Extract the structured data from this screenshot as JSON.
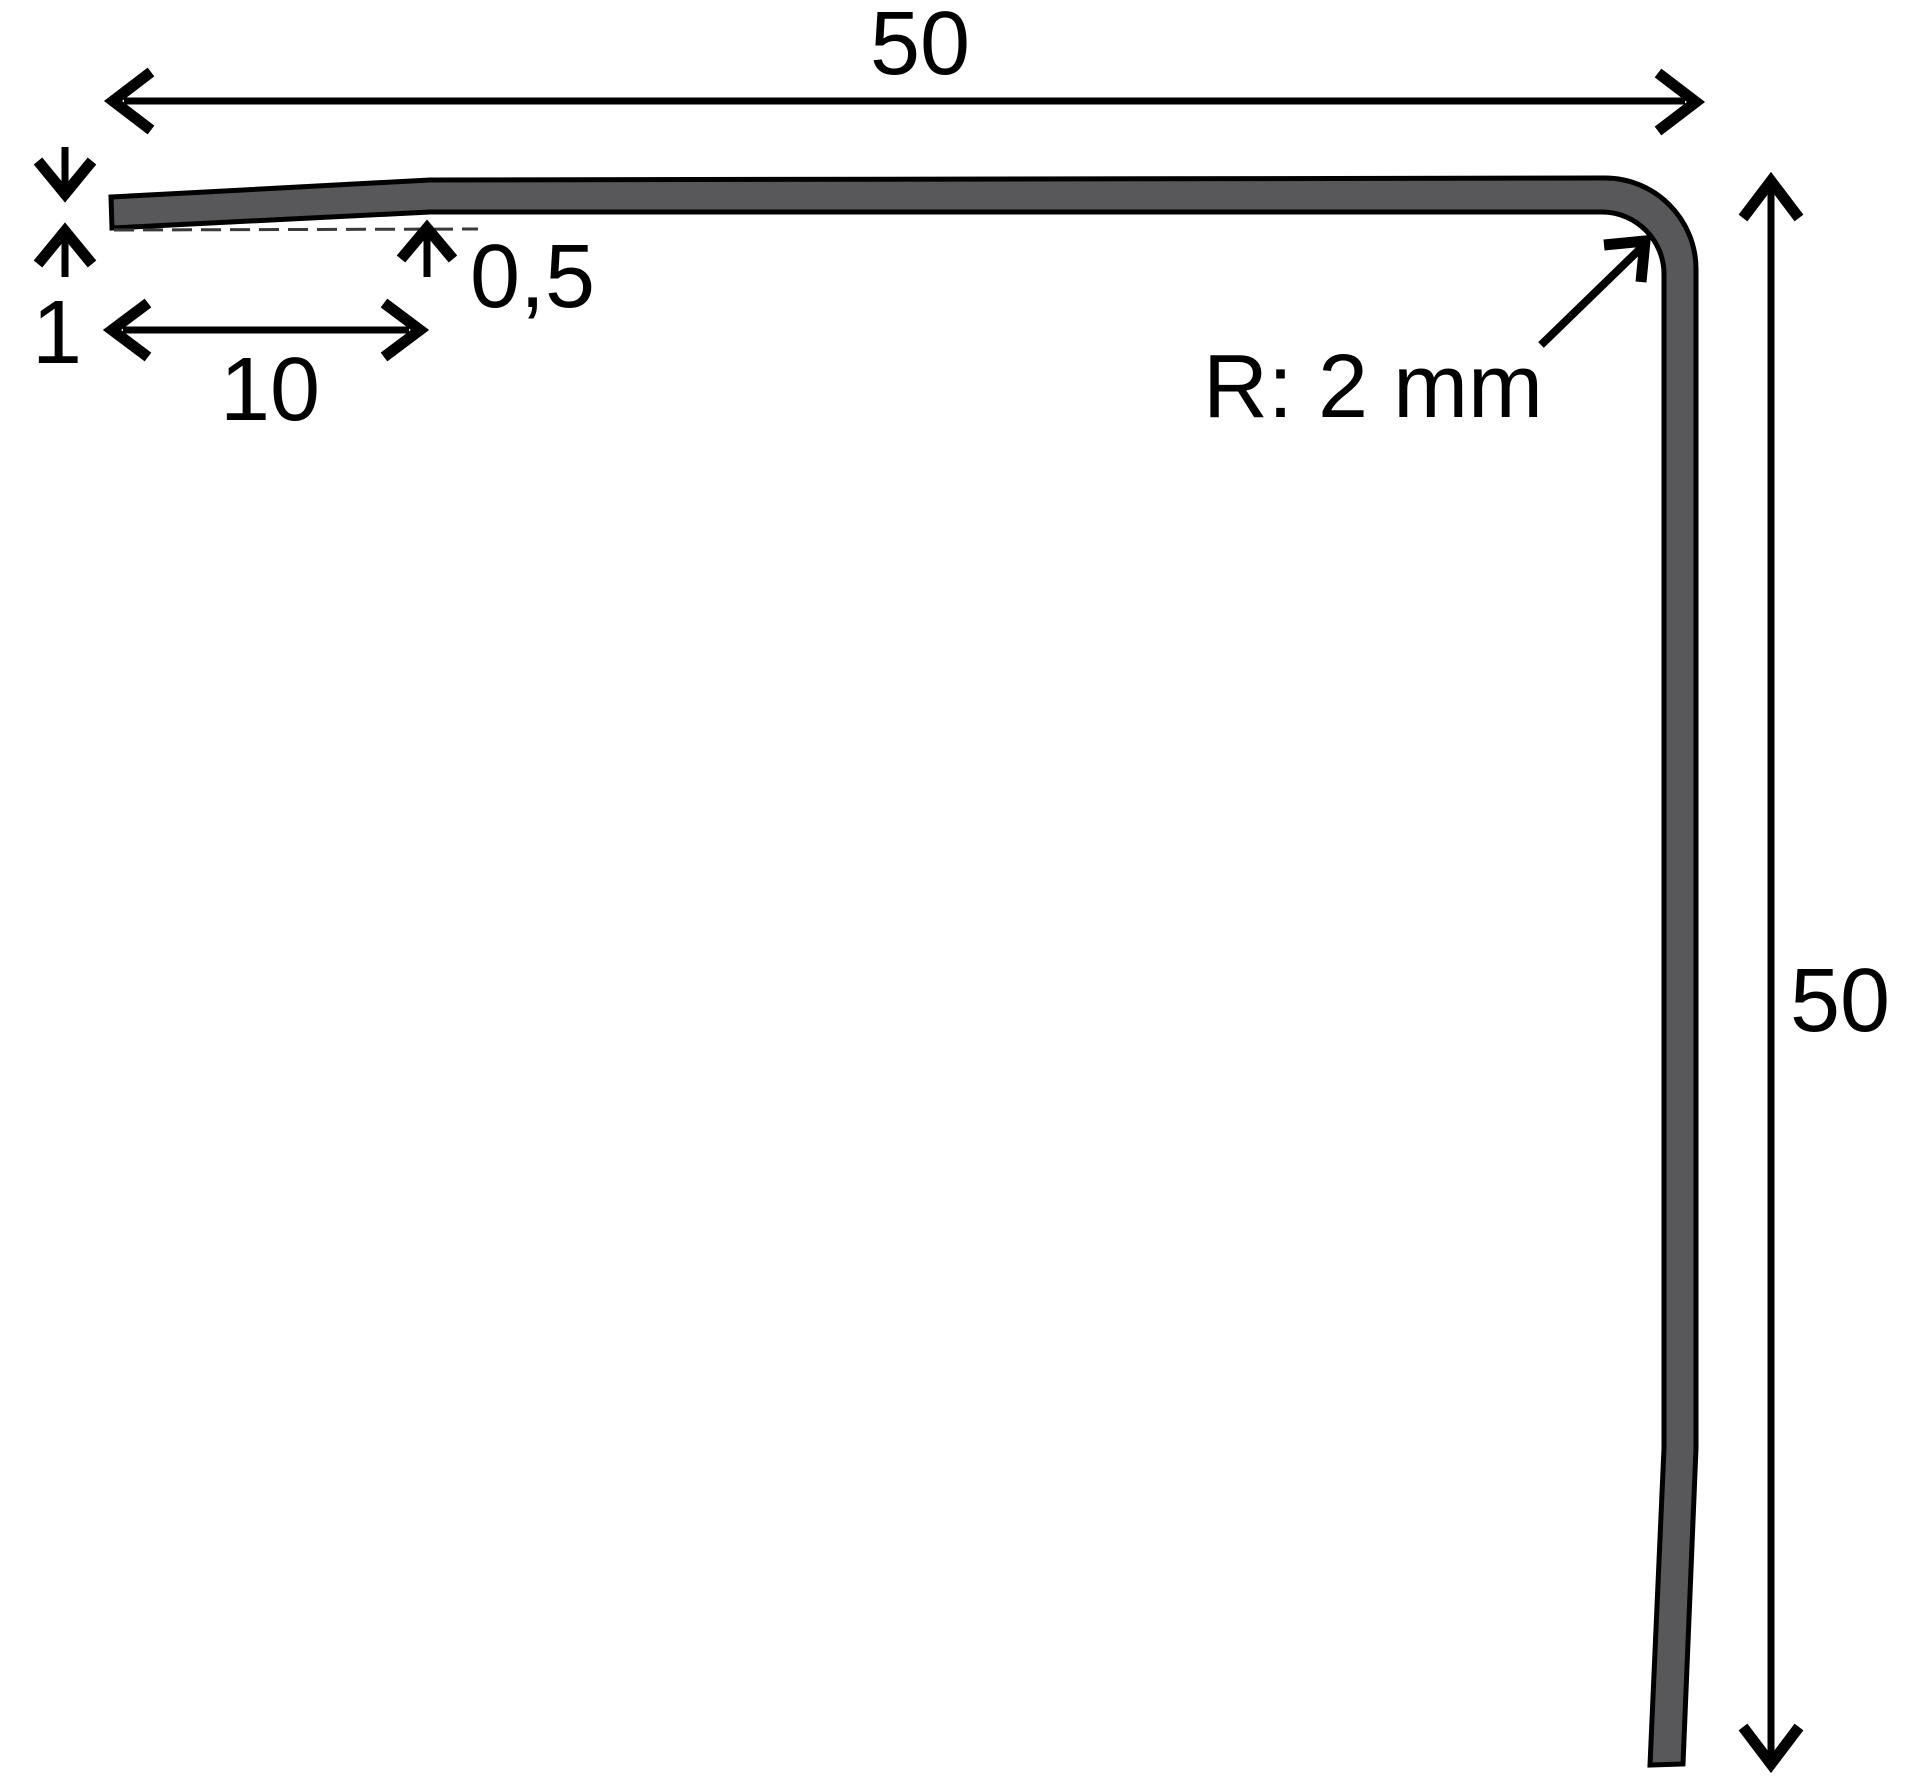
{
  "drawing": {
    "labels": {
      "width_top": "50",
      "height_right": "50",
      "tip_thickness": "1",
      "bend_offset": "0,5",
      "bend_length": "10",
      "corner_radius": "R: 2 mm"
    },
    "colors": {
      "profile_fill": "#58585a",
      "line": "#000000",
      "background": "#ffffff"
    }
  }
}
